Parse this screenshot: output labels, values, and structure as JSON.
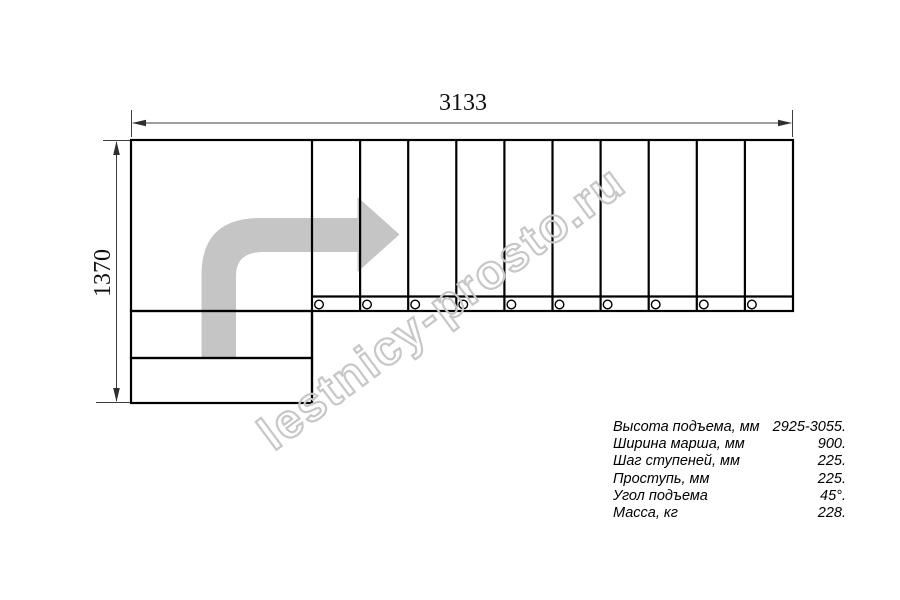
{
  "drawing": {
    "type": "staircase-plan-top-view",
    "tread_count": 10,
    "lower_step_count": 2,
    "baluster_count": 10,
    "direction_arrow": "l-turn-up-then-right"
  },
  "dimensions": {
    "width_label": "3133",
    "height_label": "1370"
  },
  "watermark": {
    "text": "lestnicy-prosto.ru"
  },
  "specs": {
    "rows": [
      {
        "label": "Высота подъема, мм",
        "value": "2925-3055."
      },
      {
        "label": "Ширина марша, мм",
        "value": "900."
      },
      {
        "label": "Шаг ступеней, мм",
        "value": "225."
      },
      {
        "label": "Проступь, мм",
        "value": "225."
      },
      {
        "label": "Угол подъема",
        "value": "45°."
      },
      {
        "label": "Масса, кг",
        "value": "228."
      }
    ]
  },
  "colors": {
    "background": "#ffffff",
    "outline": "#000000",
    "dimension_line": "#3d3d3d",
    "arrow_fill": "#c5c5c5",
    "watermark_stroke": "#c7c7c7"
  }
}
